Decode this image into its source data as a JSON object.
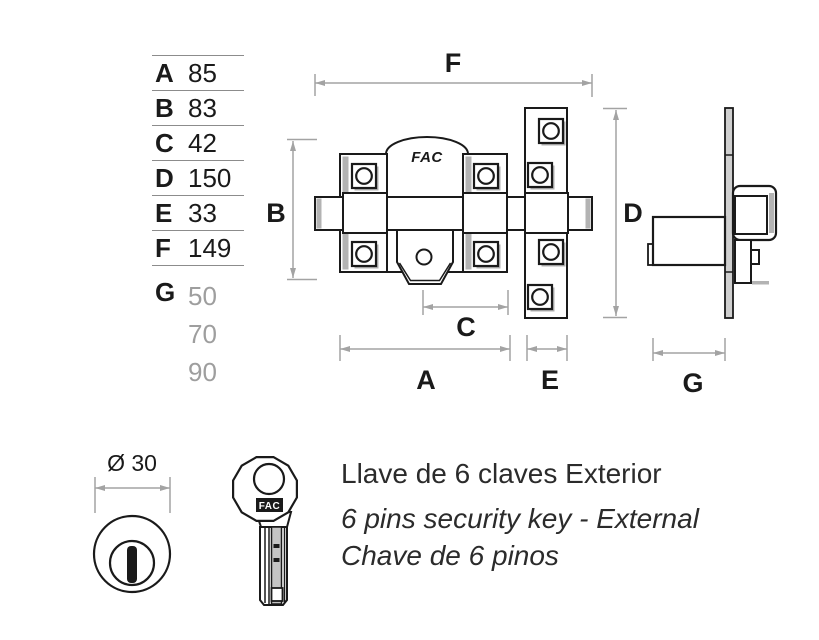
{
  "colors": {
    "ink": "#1a1a1a",
    "shade_gray": "#b3b3b3",
    "dimension_gray": "#a3a3a3",
    "muted_gray": "#9e9e9e",
    "table_rule_gray": "#8c8c8c",
    "background": "#ffffff"
  },
  "dimension_table": {
    "rows": [
      {
        "label": "A",
        "value": "85"
      },
      {
        "label": "B",
        "value": "83"
      },
      {
        "label": "C",
        "value": "42"
      },
      {
        "label": "D",
        "value": "150"
      },
      {
        "label": "E",
        "value": "33"
      },
      {
        "label": "F",
        "value": "149"
      }
    ],
    "g_row": {
      "label": "G",
      "values": [
        "50",
        "70",
        "90"
      ]
    }
  },
  "front_view": {
    "brand": "FAC",
    "label_f": "F",
    "label_b": "B",
    "label_d": "D",
    "label_c": "C",
    "label_a": "A",
    "label_e": "E"
  },
  "side_view": {
    "label_g": "G"
  },
  "cylinder_view": {
    "diameter_label": "Ø 30"
  },
  "key_view": {
    "brand": "FAC"
  },
  "caption": {
    "title_es": "Llave de 6 claves Exterior",
    "subtitle_en": "6 pins security key - External",
    "subtitle_pt": "Chave de 6 pinos"
  }
}
